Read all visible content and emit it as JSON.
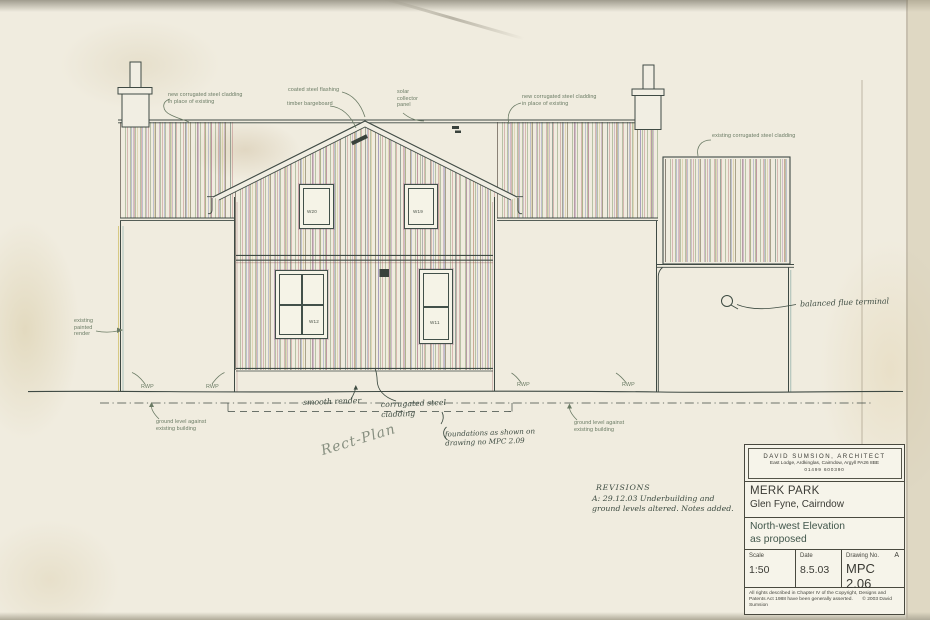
{
  "drawing": {
    "annotations": {
      "new_cladding_left": "new corrugated steel cladding\nin place of existing",
      "coated_flashing": "coated steel flashing",
      "timber_bargeboard": "timber bargeboard",
      "solar_panel": "solar\ncollector\npanel",
      "new_cladding_right": "new corrugated steel cladding\nin place of existing",
      "existing_cladding": "existing corrugated steel cladding",
      "existing_render": "existing\npainted\nrender",
      "rwp": "RWP",
      "ground_level": "ground level against\nexisting building",
      "smooth_render": "smooth render",
      "corrugated_note": "corrugated steel\ncladding",
      "foundations_note": "foundations as shown on\ndrawing no MPC 2.09",
      "plan_note": "Rect-Plan",
      "balanced_flue": "balanced flue terminal"
    },
    "windows": {
      "w20": "W20",
      "w19": "W19",
      "w12": "W12",
      "w11": "W11"
    },
    "revisions": {
      "title": "REVISIONS",
      "entry": "A: 29.12.03  Underbuilding and\nground levels altered.  Notes added."
    }
  },
  "title_block": {
    "architect": {
      "name": "DAVID SUMSION,  ARCHITECT",
      "address": "East Lodge, Ardkinglas, Cairndow, Argyll  PA26 8BE",
      "phone": "01499 600390"
    },
    "project": {
      "name": "MERK PARK",
      "location": "Glen Fyne, Cairndow"
    },
    "sheet": {
      "title_line1": "North-west Elevation",
      "title_line2": "as proposed"
    },
    "scale": {
      "label": "Scale",
      "value": "1:50"
    },
    "date": {
      "label": "Date",
      "value": "8.5.03"
    },
    "drawing_no": {
      "label": "Drawing No.",
      "value": "MPC 2.06",
      "revision": "A"
    },
    "copyright": "All rights described in Chapter IV of the Copyright, Designs and Patents Act 1988 have been generally asserted.",
    "copyright_owner": "© 2003   David Sumsion"
  },
  "colors": {
    "paper": "#f0ecdf",
    "ink": "#3f4a44",
    "annotation_ink": "#697a63",
    "handwriting_ink": "#3e4c42",
    "pencil": "#878f80"
  }
}
